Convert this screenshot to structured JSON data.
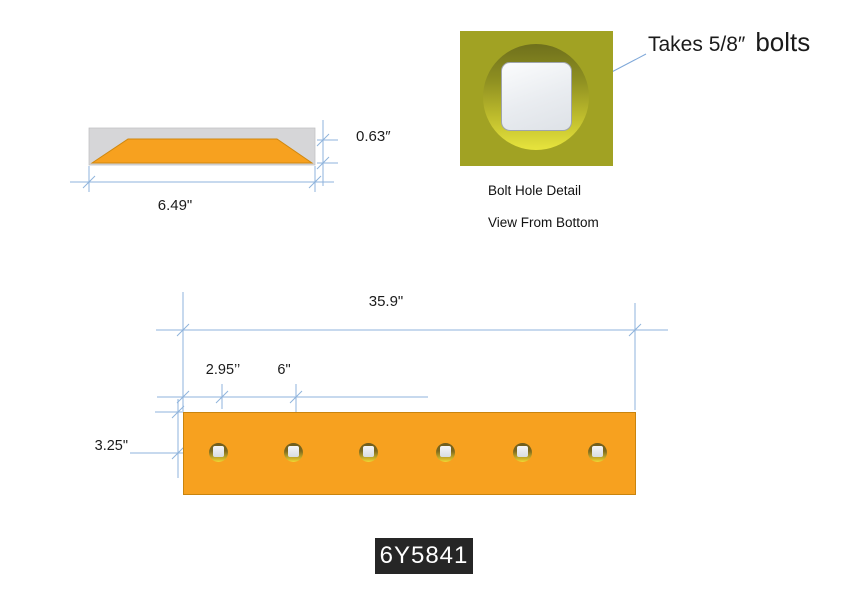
{
  "part_number": "6Y5841",
  "cross_section": {
    "width": "6.49\"",
    "thickness": "0.63″"
  },
  "bolt_hole_detail": {
    "callout_prefix": "Takes 5/8″",
    "callout_suffix": "bolts",
    "title": "Bolt Hole Detail",
    "subtitle": "View From Bottom"
  },
  "plate": {
    "length": "35.9\"",
    "edge_to_first_hole": "2.95’’",
    "hole_spacing": "6\"",
    "top_edge_to_hole_row": "3.25\"",
    "hole_count": 6
  },
  "colors": {
    "plate_orange": "#F7A11F",
    "dimension_blue": "#8FB3DC",
    "detail_olive": "#A1A223",
    "label_background": "#262626"
  }
}
